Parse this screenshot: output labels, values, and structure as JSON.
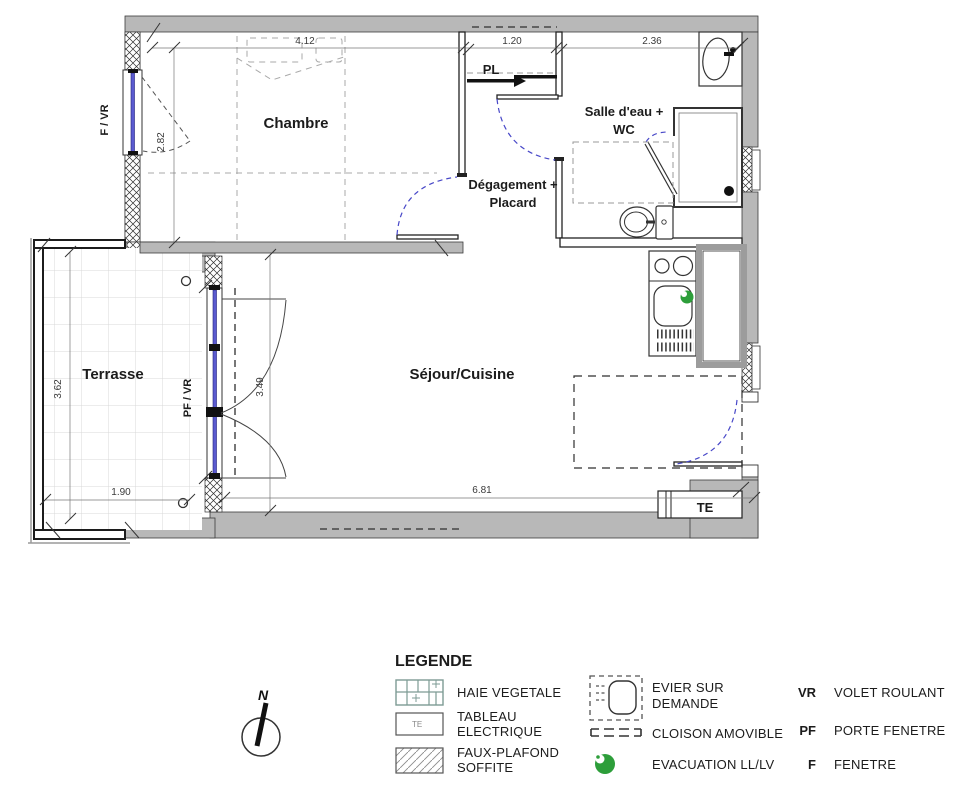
{
  "colors": {
    "wall_gray": "#b8b8b8",
    "window_blue": "#5b5bd0",
    "door_arc_blue": "#4848c8",
    "evacuation_green": "#2d9e3a"
  },
  "plan": {
    "rooms": {
      "chambre": "Chambre",
      "salle_eau_line1": "Salle d'eau +",
      "salle_eau_line2": "WC",
      "degagement_line1": "Dégagement +",
      "degagement_line2": "Placard",
      "sejour": "Séjour/Cuisine",
      "terrasse": "Terrasse",
      "placard": "PL"
    },
    "annotations": {
      "f_vr": "F / VR",
      "pf_vr": "PF / VR",
      "te": "TE",
      "north": "N"
    },
    "dimensions": {
      "chambre_width": "4.12",
      "pl_width": "1.20",
      "salle_eau_width": "2.36",
      "chambre_depth": "2.82",
      "sejour_depth": "3.49",
      "terrasse_depth": "3.62",
      "terrasse_width": "1.90",
      "sejour_width": "6.81"
    }
  },
  "legend": {
    "title": "LEGENDE",
    "items": {
      "haie": "HAIE VEGETALE",
      "tableau_line1": "TABLEAU",
      "tableau_line2": "ELECTRIQUE",
      "tableau_symbol": "TE",
      "faux_line1": "FAUX-PLAFOND",
      "faux_line2": "SOFFITE",
      "evier_line1": "EVIER SUR",
      "evier_line2": "DEMANDE",
      "cloison": "CLOISON AMOVIBLE",
      "evacuation": "EVACUATION LL/LV",
      "vr_abbr": "VR",
      "vr_label": "VOLET ROULANT",
      "pf_abbr": "PF",
      "pf_label": "PORTE FENETRE",
      "f_abbr": "F",
      "f_label": "FENETRE"
    }
  }
}
